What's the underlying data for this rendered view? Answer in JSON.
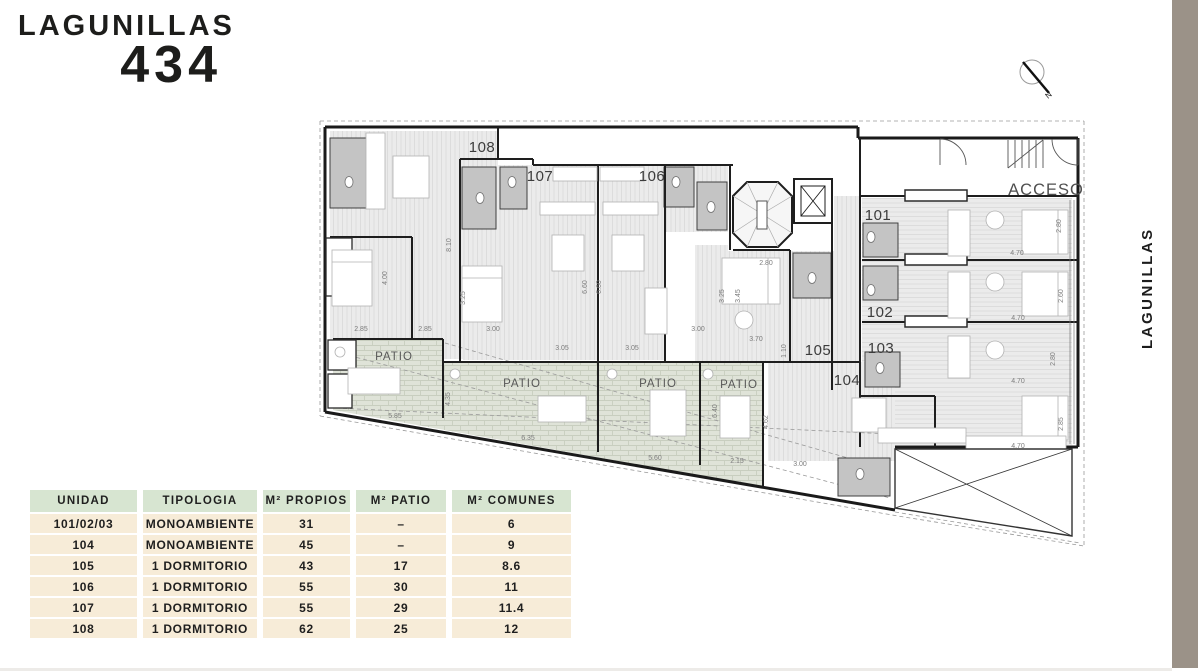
{
  "brand": {
    "name": "LAGUNILLAS",
    "number": "434"
  },
  "sidebar": {
    "street": "LAGUNILLAS",
    "floor_main": "PLANTA 1",
    "floor_sup": "ER",
    "floor_tail": " PISO",
    "bar_color": "#9b9288"
  },
  "compass": {
    "north": "N"
  },
  "plan": {
    "acceso": {
      "text": "ACCESO",
      "x": 1046,
      "y": 195
    },
    "patio_label": "PATIO",
    "patio_positions": [
      {
        "x": 394,
        "y": 360
      },
      {
        "x": 522,
        "y": 387
      },
      {
        "x": 658,
        "y": 387
      },
      {
        "x": 739,
        "y": 388
      }
    ],
    "unit_labels": [
      {
        "text": "108",
        "x": 482,
        "y": 152
      },
      {
        "text": "107",
        "x": 540,
        "y": 181
      },
      {
        "text": "106",
        "x": 652,
        "y": 181
      },
      {
        "text": "101",
        "x": 878,
        "y": 220
      },
      {
        "text": "102",
        "x": 880,
        "y": 317
      },
      {
        "text": "103",
        "x": 881,
        "y": 353
      },
      {
        "text": "104",
        "x": 847,
        "y": 385
      },
      {
        "text": "105",
        "x": 818,
        "y": 355
      }
    ],
    "dimensions": [
      {
        "text": "2.85",
        "x": 361,
        "y": 331,
        "rot": 0
      },
      {
        "text": "2.85",
        "x": 425,
        "y": 331,
        "rot": 0
      },
      {
        "text": "3.00",
        "x": 493,
        "y": 331,
        "rot": 0
      },
      {
        "text": "4.00",
        "x": 387,
        "y": 278,
        "rot": -90
      },
      {
        "text": "8.10",
        "x": 451,
        "y": 245,
        "rot": -90
      },
      {
        "text": "3.25",
        "x": 465,
        "y": 298,
        "rot": -90
      },
      {
        "text": "6.60",
        "x": 587,
        "y": 287,
        "rot": -90
      },
      {
        "text": "6.60",
        "x": 601,
        "y": 287,
        "rot": -90
      },
      {
        "text": "3.05",
        "x": 562,
        "y": 350,
        "rot": 0
      },
      {
        "text": "3.05",
        "x": 632,
        "y": 350,
        "rot": 0
      },
      {
        "text": "3.00",
        "x": 698,
        "y": 331,
        "rot": 0
      },
      {
        "text": "2.80",
        "x": 766,
        "y": 265,
        "rot": 0
      },
      {
        "text": "3.25",
        "x": 724,
        "y": 296,
        "rot": -90
      },
      {
        "text": "3.45",
        "x": 740,
        "y": 296,
        "rot": -90
      },
      {
        "text": "3.70",
        "x": 756,
        "y": 341,
        "rot": 0
      },
      {
        "text": "1.10",
        "x": 786,
        "y": 351,
        "rot": -90
      },
      {
        "text": "2.80",
        "x": 1061,
        "y": 226,
        "rot": -90
      },
      {
        "text": "4.70",
        "x": 1017,
        "y": 255,
        "rot": 0
      },
      {
        "text": "2.60",
        "x": 1063,
        "y": 296,
        "rot": -90
      },
      {
        "text": "4.70",
        "x": 1018,
        "y": 320,
        "rot": 0
      },
      {
        "text": "2.80",
        "x": 1055,
        "y": 359,
        "rot": -90
      },
      {
        "text": "4.70",
        "x": 1018,
        "y": 383,
        "rot": 0
      },
      {
        "text": "2.85",
        "x": 1063,
        "y": 424,
        "rot": -90
      },
      {
        "text": "4.70",
        "x": 1018,
        "y": 448,
        "rot": 0
      },
      {
        "text": "5.85",
        "x": 395,
        "y": 418,
        "rot": 0
      },
      {
        "text": "4.35",
        "x": 450,
        "y": 399,
        "rot": -90
      },
      {
        "text": "6.35",
        "x": 528,
        "y": 440,
        "rot": 0
      },
      {
        "text": "5.60",
        "x": 655,
        "y": 460,
        "rot": 0
      },
      {
        "text": "6.40",
        "x": 717,
        "y": 411,
        "rot": -90
      },
      {
        "text": "2.15",
        "x": 737,
        "y": 463,
        "rot": 0
      },
      {
        "text": "3.00",
        "x": 800,
        "y": 466,
        "rot": 0
      },
      {
        "text": "4.62",
        "x": 768,
        "y": 422,
        "rot": -90
      }
    ]
  },
  "table": {
    "header_bg": "#d7e5d1",
    "row_bg": "#f7ecd8",
    "headers": [
      "UNIDAD",
      "TIPOLOGIA",
      "M² PROPIOS",
      "M² PATIO",
      "M² COMUNES"
    ],
    "rows": [
      [
        "101/02/03",
        "MONOAMBIENTE",
        "31",
        "–",
        "6"
      ],
      [
        "104",
        "MONOAMBIENTE",
        "45",
        "–",
        "9"
      ],
      [
        "105",
        "1 DORMITORIO",
        "43",
        "17",
        "8.6"
      ],
      [
        "106",
        "1 DORMITORIO",
        "55",
        "30",
        "11"
      ],
      [
        "107",
        "1 DORMITORIO",
        "55",
        "29",
        "11.4"
      ],
      [
        "108",
        "1 DORMITORIO",
        "62",
        "25",
        "12"
      ]
    ]
  }
}
